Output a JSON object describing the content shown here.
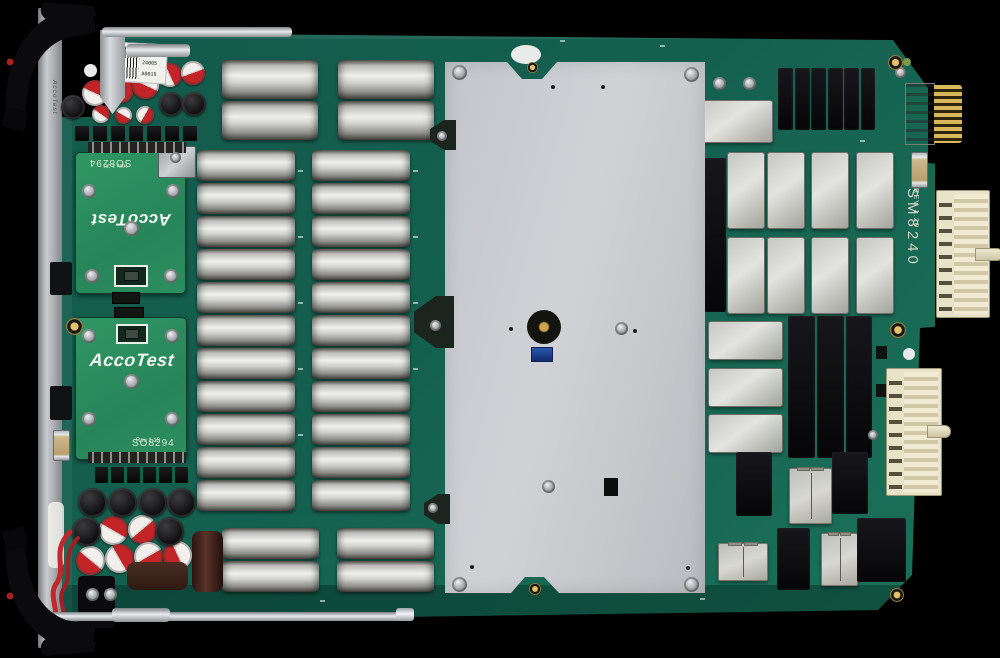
{
  "meta": {
    "description": "Top view photograph of an AccoTest SM8240 instrument card PCB with ejector handles, capacitor banks, relay cans, shield plate and backplane connectors"
  },
  "texts": {
    "front_panel": "AccoTest",
    "label_lines": [
      "M8240",
      "24005",
      "A0015"
    ],
    "db_top": {
      "title": "SO8294",
      "rev": "Rev 1.20",
      "logo": "AccoTest"
    },
    "db_bottom": {
      "title": "SO8294",
      "rev": "Rev 1.13",
      "logo": "AccoTest"
    },
    "model": "SM8240",
    "model_rev": "REV 1.20"
  },
  "colors": {
    "background": "#000000",
    "pcb_green": "#14604f",
    "daughterboard_green": "#2c8f5e",
    "shield_plate": "#c7cacd",
    "relay_gray": "#c6c6c2",
    "relay_black": "#0a0a0c",
    "connector_cream": "#e8e2c8",
    "gold": "#d9b85a",
    "capacitor_red": "#c22428"
  },
  "board": {
    "silver_caps": [
      [
        222,
        60,
        96,
        39
      ],
      [
        222,
        101,
        96,
        39
      ],
      [
        338,
        60,
        96,
        39
      ],
      [
        338,
        101,
        96,
        39
      ],
      [
        197,
        150,
        98,
        31
      ],
      [
        197,
        183,
        98,
        31
      ],
      [
        197,
        216,
        98,
        31
      ],
      [
        197,
        249,
        98,
        31
      ],
      [
        197,
        282,
        98,
        31
      ],
      [
        197,
        315,
        98,
        31
      ],
      [
        197,
        348,
        98,
        31
      ],
      [
        197,
        381,
        98,
        31
      ],
      [
        197,
        414,
        98,
        31
      ],
      [
        197,
        447,
        98,
        31
      ],
      [
        197,
        480,
        98,
        31
      ],
      [
        312,
        150,
        98,
        31
      ],
      [
        312,
        183,
        98,
        31
      ],
      [
        312,
        216,
        98,
        31
      ],
      [
        312,
        249,
        98,
        31
      ],
      [
        312,
        282,
        98,
        31
      ],
      [
        312,
        315,
        98,
        31
      ],
      [
        312,
        348,
        98,
        31
      ],
      [
        312,
        381,
        98,
        31
      ],
      [
        312,
        414,
        98,
        31
      ],
      [
        312,
        447,
        98,
        31
      ],
      [
        312,
        480,
        98,
        31
      ],
      [
        222,
        528,
        97,
        31
      ],
      [
        222,
        561,
        97,
        31
      ],
      [
        337,
        528,
        97,
        31
      ],
      [
        337,
        561,
        97,
        31
      ]
    ],
    "red_white_caps": [
      [
        82,
        80,
        26,
        25
      ],
      [
        107,
        76,
        27,
        115
      ],
      [
        132,
        72,
        27,
        205
      ],
      [
        158,
        63,
        24,
        65
      ],
      [
        181,
        61,
        24,
        160
      ],
      [
        92,
        105,
        18,
        35
      ],
      [
        115,
        107,
        17,
        210
      ],
      [
        136,
        106,
        18,
        120
      ],
      [
        99,
        516,
        29,
        30
      ],
      [
        128,
        515,
        29,
        140
      ],
      [
        76,
        546,
        29,
        220
      ],
      [
        105,
        544,
        29,
        60
      ],
      [
        134,
        542,
        29,
        150
      ],
      [
        163,
        541,
        29,
        245
      ]
    ],
    "black_caps": [
      [
        61,
        95,
        24
      ],
      [
        159,
        92,
        24
      ],
      [
        182,
        92,
        24
      ],
      [
        78,
        488,
        29
      ],
      [
        108,
        488,
        29
      ],
      [
        138,
        488,
        29
      ],
      [
        167,
        488,
        29
      ],
      [
        72,
        517,
        29
      ],
      [
        155,
        517,
        29
      ]
    ],
    "gray_relays": [
      [
        727,
        152,
        38,
        77
      ],
      [
        767,
        152,
        38,
        77
      ],
      [
        811,
        152,
        38,
        77
      ],
      [
        856,
        152,
        38,
        77
      ],
      [
        727,
        237,
        38,
        77
      ],
      [
        767,
        237,
        38,
        77
      ],
      [
        811,
        237,
        38,
        77
      ],
      [
        856,
        237,
        38,
        77
      ],
      [
        708,
        321,
        75,
        39
      ],
      [
        708,
        368,
        75,
        39
      ],
      [
        708,
        414,
        75,
        39
      ],
      [
        697,
        100,
        76,
        43
      ]
    ],
    "lined_relays": [
      [
        789,
        468,
        43,
        56
      ],
      [
        718,
        543,
        50,
        38
      ],
      [
        821,
        533,
        37,
        53
      ]
    ],
    "black_relays": [
      [
        778,
        68,
        15,
        62
      ],
      [
        795,
        68,
        15,
        62
      ],
      [
        811,
        68,
        15,
        62
      ],
      [
        828,
        68,
        15,
        62
      ],
      [
        844,
        68,
        15,
        62
      ],
      [
        861,
        68,
        14,
        62
      ],
      [
        704,
        158,
        22,
        154
      ],
      [
        788,
        316,
        27,
        142
      ],
      [
        817,
        316,
        27,
        142
      ],
      [
        846,
        316,
        26,
        142
      ],
      [
        736,
        452,
        36,
        64
      ],
      [
        832,
        452,
        36,
        62
      ],
      [
        777,
        528,
        33,
        62
      ],
      [
        857,
        518,
        49,
        64
      ]
    ],
    "screws": [
      [
        452,
        65,
        15
      ],
      [
        684,
        67,
        15
      ],
      [
        452,
        577,
        15
      ],
      [
        684,
        577,
        15
      ],
      [
        615,
        322,
        13
      ],
      [
        542,
        480,
        13
      ],
      [
        86,
        588,
        13
      ],
      [
        104,
        588,
        13
      ],
      [
        82,
        184,
        14
      ],
      [
        166,
        184,
        14
      ],
      [
        124,
        221,
        15
      ],
      [
        85,
        269,
        14
      ],
      [
        164,
        269,
        14
      ],
      [
        82,
        329,
        14
      ],
      [
        165,
        329,
        14
      ],
      [
        124,
        374,
        15
      ],
      [
        82,
        412,
        14
      ],
      [
        165,
        412,
        14
      ],
      [
        713,
        77,
        13
      ],
      [
        743,
        77,
        13
      ],
      [
        895,
        67,
        11
      ],
      [
        170,
        152,
        11
      ],
      [
        437,
        131,
        10
      ],
      [
        430,
        320,
        11
      ],
      [
        428,
        503,
        10
      ],
      [
        868,
        430,
        10
      ]
    ],
    "brass": [
      [
        888,
        55,
        15
      ],
      [
        890,
        322,
        16
      ],
      [
        890,
        588,
        14
      ],
      [
        66,
        318,
        17
      ]
    ],
    "brass_under": [
      [
        527,
        62,
        11
      ],
      [
        529,
        583,
        12
      ]
    ],
    "white_dots": [
      [
        84,
        64,
        13
      ],
      [
        103,
        64,
        13
      ],
      [
        903,
        348,
        12
      ],
      [
        903,
        386,
        12
      ]
    ],
    "black_sq": [
      [
        876,
        346,
        11,
        13
      ],
      [
        876,
        384,
        11,
        13
      ]
    ],
    "dot_black": [
      [
        551,
        85,
        4
      ],
      [
        601,
        85,
        4
      ],
      [
        509,
        327,
        4
      ],
      [
        633,
        329,
        4
      ],
      [
        470,
        565,
        4
      ],
      [
        686,
        566,
        4
      ]
    ],
    "silk": [
      [
        298,
        170
      ],
      [
        298,
        236
      ],
      [
        298,
        302
      ],
      [
        298,
        368
      ],
      [
        298,
        434
      ],
      [
        413,
        170
      ],
      [
        413,
        236
      ],
      [
        413,
        302
      ],
      [
        413,
        368
      ],
      [
        660,
        45
      ],
      [
        690,
        342
      ],
      [
        756,
        312
      ],
      [
        700,
        598
      ],
      [
        320,
        600
      ],
      [
        560,
        40
      ],
      [
        860,
        140
      ]
    ],
    "parts": [
      {
        "c": "pinheader",
        "n": "pin-header",
        "r": [
          88,
          142,
          98,
          11
        ]
      },
      {
        "c": "pinheader",
        "n": "pin-header",
        "r": [
          88,
          452,
          98,
          11
        ]
      },
      {
        "c": "conblock",
        "n": "board-connector",
        "r": [
          112,
          292,
          28,
          12
        ]
      },
      {
        "c": "conblock",
        "n": "board-connector",
        "r": [
          114,
          307,
          30,
          11
        ]
      },
      {
        "c": "trans",
        "n": "transistor",
        "r": [
          75,
          126,
          14,
          15
        ]
      },
      {
        "c": "trans",
        "n": "transistor",
        "r": [
          93,
          126,
          14,
          15
        ]
      },
      {
        "c": "trans",
        "n": "transistor",
        "r": [
          111,
          126,
          14,
          15
        ]
      },
      {
        "c": "trans",
        "n": "transistor",
        "r": [
          129,
          126,
          14,
          15
        ]
      },
      {
        "c": "trans",
        "n": "transistor",
        "r": [
          147,
          126,
          14,
          15
        ]
      },
      {
        "c": "trans",
        "n": "transistor",
        "r": [
          165,
          126,
          14,
          15
        ]
      },
      {
        "c": "trans",
        "n": "transistor",
        "r": [
          183,
          126,
          14,
          15
        ]
      },
      {
        "c": "trans",
        "n": "transistor",
        "r": [
          95,
          467,
          13,
          16
        ]
      },
      {
        "c": "trans",
        "n": "transistor",
        "r": [
          111,
          467,
          13,
          16
        ]
      },
      {
        "c": "trans",
        "n": "transistor",
        "r": [
          127,
          467,
          13,
          16
        ]
      },
      {
        "c": "trans",
        "n": "transistor",
        "r": [
          143,
          467,
          13,
          16
        ]
      },
      {
        "c": "trans",
        "n": "transistor",
        "r": [
          159,
          467,
          13,
          16
        ]
      },
      {
        "c": "trans",
        "n": "transistor",
        "r": [
          175,
          467,
          13,
          16
        ]
      },
      {
        "c": "ic",
        "n": "ic-chip",
        "r": [
          50,
          262,
          22,
          33
        ]
      },
      {
        "c": "ic",
        "n": "ic-chip",
        "r": [
          50,
          386,
          22,
          34
        ]
      },
      {
        "c": "fuse",
        "n": "fuse",
        "r": [
          53,
          430,
          17,
          31
        ]
      },
      {
        "c": "fuse",
        "n": "fuse",
        "r": [
          911,
          152,
          17,
          36
        ]
      },
      {
        "c": "brownbox",
        "n": "inductor-brown",
        "r": [
          127,
          562,
          61,
          28
        ]
      },
      {
        "c": "browncyl",
        "n": "capacitor-brown",
        "r": [
          192,
          531,
          31,
          61
        ]
      },
      {
        "c": "whitestrip",
        "n": "plastic-strip",
        "r": [
          48,
          502,
          16,
          66
        ]
      },
      {
        "c": "blackbracket",
        "n": "terminal-block",
        "r": [
          78,
          576,
          37,
          52
        ]
      },
      {
        "c": "platetab",
        "n": "plate-bracket",
        "r": [
          430,
          120,
          26,
          30
        ]
      },
      {
        "c": "platetab",
        "n": "plate-bracket",
        "r": [
          414,
          296,
          40,
          52
        ]
      },
      {
        "c": "platetab",
        "n": "plate-bracket",
        "r": [
          424,
          494,
          26,
          30
        ]
      },
      {
        "c": "slotblack",
        "n": "plate-slot",
        "r": [
          604,
          478,
          14,
          18
        ]
      },
      {
        "c": "sq-black",
        "n": "smd-component",
        "r": [
          628,
          303,
          10,
          16
        ]
      }
    ]
  }
}
